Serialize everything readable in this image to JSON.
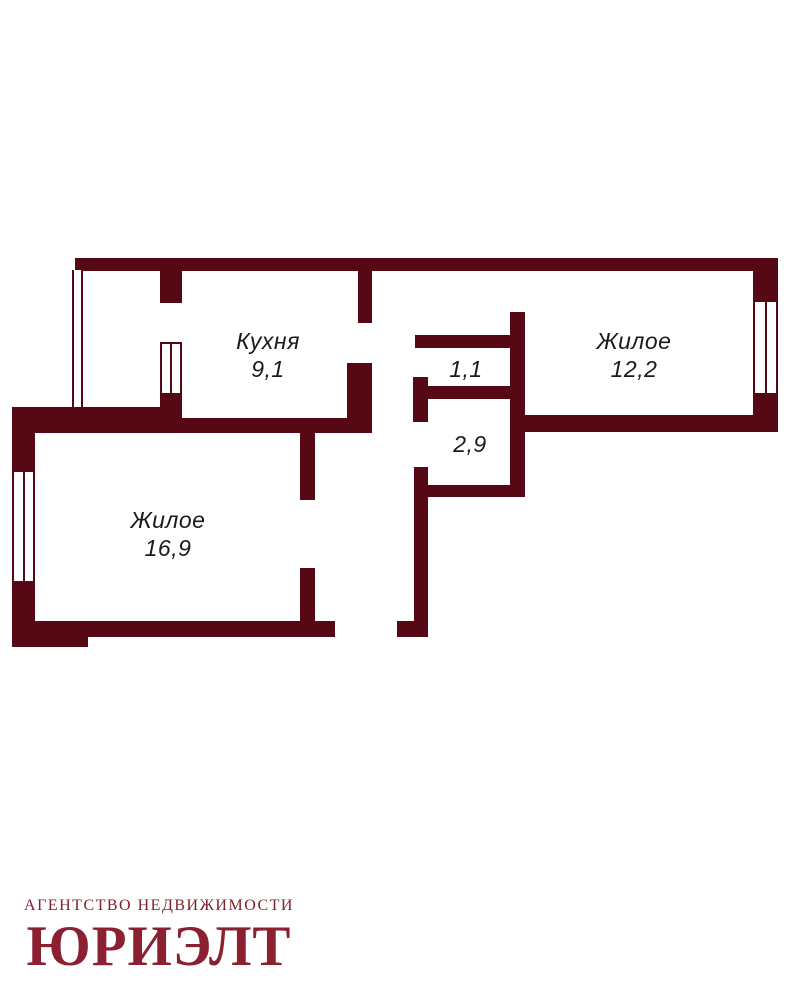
{
  "page": {
    "background": "#ffffff",
    "kind": "apartment floor plan"
  },
  "colors": {
    "wall": "#560814",
    "label_text": "#1a1a1a",
    "logo_primary": "#8b2130",
    "logo_secondary": "#7d1f2a"
  },
  "floorplan": {
    "type": "2-room apartment plan",
    "rooms": [
      {
        "id": "kitchen",
        "name": "Кухня",
        "area": "9,1"
      },
      {
        "id": "living-1",
        "name": "Жилое",
        "area": "12,2"
      },
      {
        "id": "hallway",
        "name": "",
        "area": "1,1"
      },
      {
        "id": "corridor",
        "name": "",
        "area": "2,9"
      },
      {
        "id": "living-2",
        "name": "Жилое",
        "area": "16,9"
      }
    ]
  },
  "logo": {
    "agency_line": "АГЕНТСТВО НЕДВИЖИМОСТИ",
    "brand": "ЮРИЭЛТ"
  }
}
